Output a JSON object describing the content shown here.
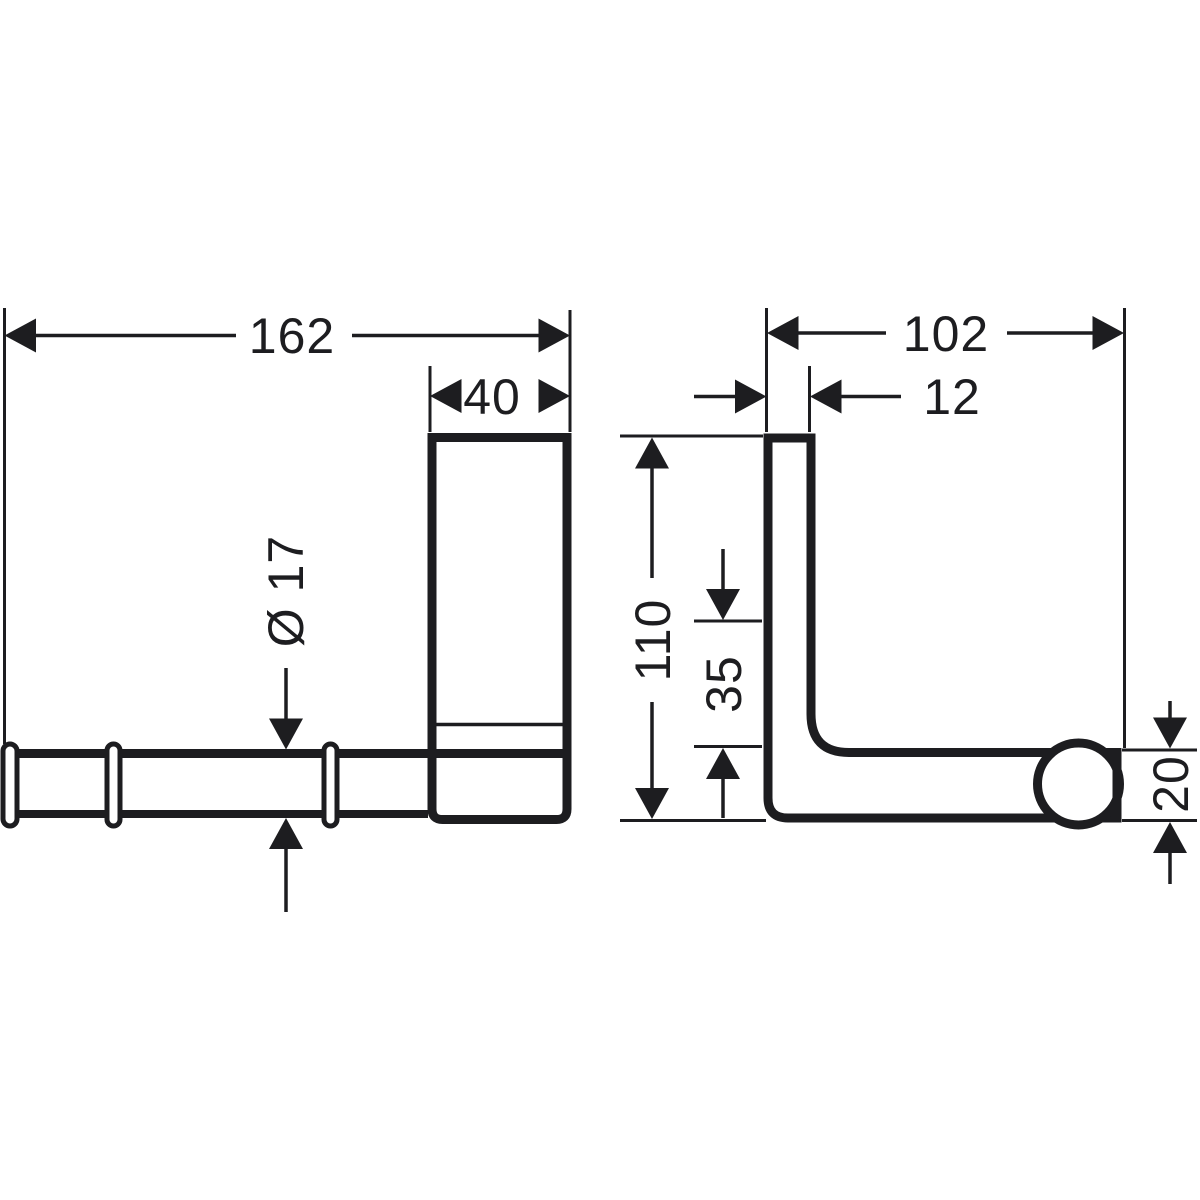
{
  "drawing": {
    "type": "technical-dimension-drawing",
    "views": {
      "front": {
        "bar_length": "162",
        "plate_width": "40",
        "bar_diameter": "Ø 17"
      },
      "side": {
        "depth": "102",
        "plate_thickness": "12",
        "height": "110",
        "inner_offset": "35",
        "end_height": "20"
      }
    },
    "colors": {
      "line": "#1d1d20",
      "background": "#ffffff"
    }
  }
}
